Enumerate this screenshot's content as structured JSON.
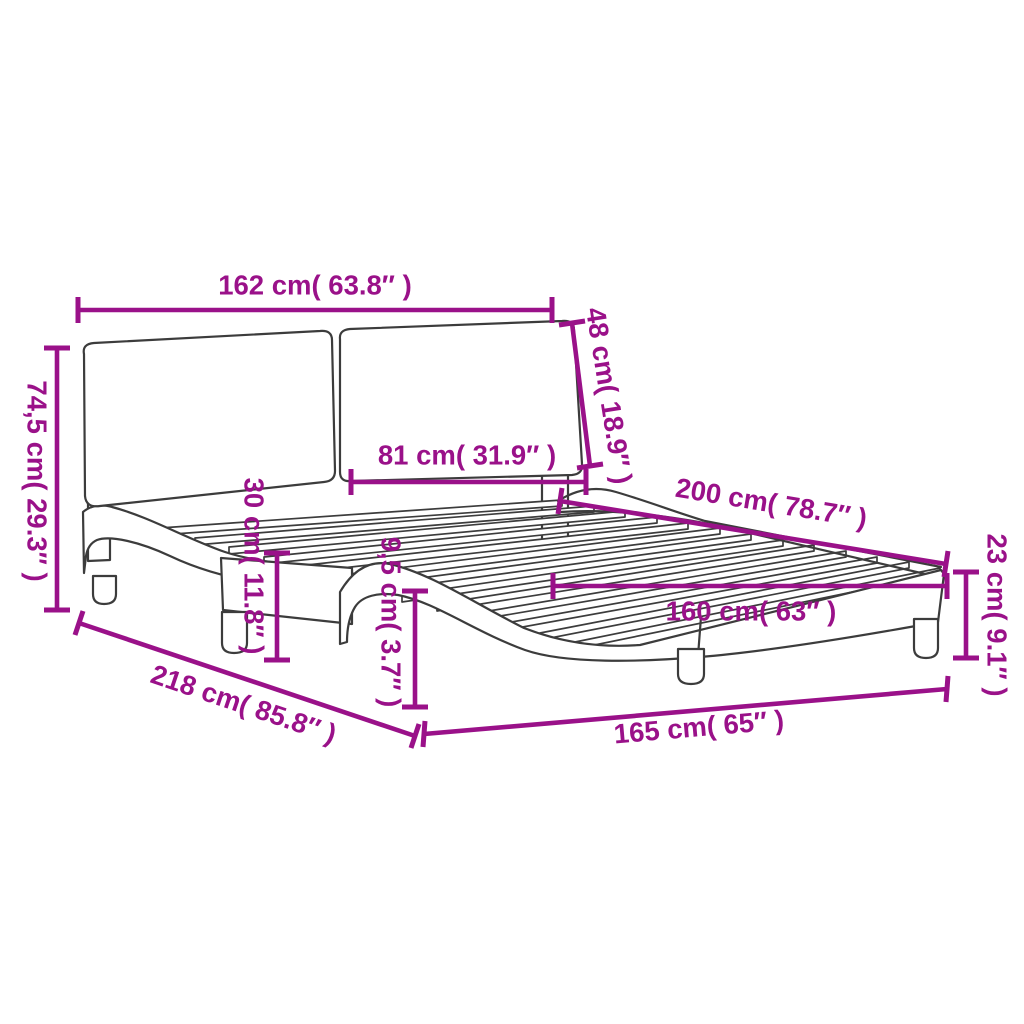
{
  "colors": {
    "dimension_annotation": "#9A1189",
    "drawing_outline": "#3C3C3C",
    "background": "#FFFFFF"
  },
  "diagram": {
    "subject": "bed-frame-with-tufted-headboard-dimension-diagram"
  },
  "dimensions": [
    {
      "id": "headboard-width",
      "label": "162 cm( 63.8″ )"
    },
    {
      "id": "headboard-panel-height",
      "label": "48 cm( 18.9″ )"
    },
    {
      "id": "headboard-total-height",
      "label": "74,5 cm( 29.3″ )"
    },
    {
      "id": "headboard-panel-width",
      "label": "81 cm( 31.9″ )"
    },
    {
      "id": "side-rail-height",
      "label": "30 cm( 11.8″ )"
    },
    {
      "id": "frame-edge-height",
      "label": "9,5 cm( 3.7″ )"
    },
    {
      "id": "bed-length",
      "label": "200 cm( 78.7″ )"
    },
    {
      "id": "base-height",
      "label": "23 cm( 9.1″ )"
    },
    {
      "id": "slat-base-width",
      "label": "160 cm( 63″ )"
    },
    {
      "id": "total-length",
      "label": "218 cm( 85.8″ )"
    },
    {
      "id": "total-width",
      "label": "165 cm( 65″ )"
    }
  ]
}
